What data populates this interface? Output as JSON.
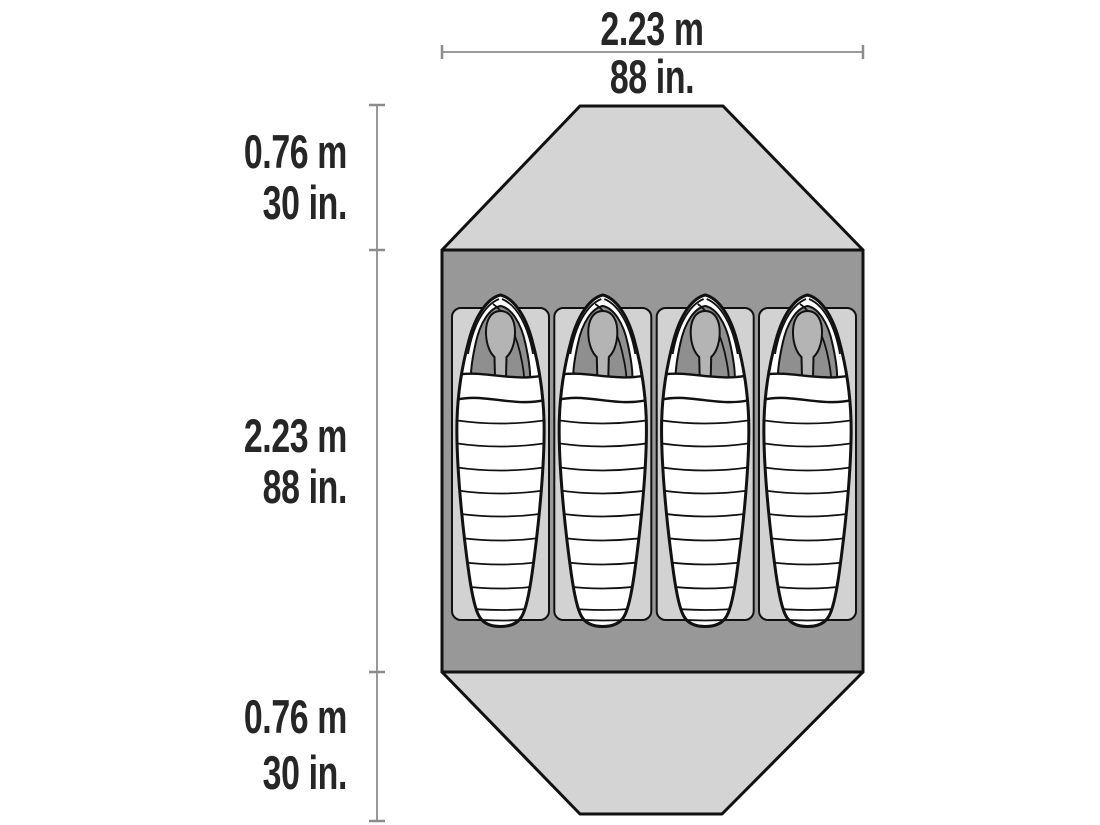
{
  "diagram": {
    "type": "tent-floorplan",
    "sleeper_count": 4,
    "width_dimension": {
      "metric": "2.23 m",
      "imperial": "88 in."
    },
    "side_dimensions": [
      {
        "section": "top-vestibule",
        "metric": "0.76 m",
        "imperial": "30 in."
      },
      {
        "section": "floor",
        "metric": "2.23 m",
        "imperial": "88 in."
      },
      {
        "section": "bottom-vestibule",
        "metric": "0.76 m",
        "imperial": "30 in."
      }
    ]
  },
  "colors": {
    "background": "#ffffff",
    "vestibule": "#d4d4d4",
    "floor": "#989898",
    "pad": "#d2d2d2",
    "bag": "#ffffff",
    "hood_interior": "#8f8f8f",
    "face": "#b4b4b4",
    "outline": "#111111",
    "dimension_line": "#8c8c8c",
    "text": "#262626"
  }
}
